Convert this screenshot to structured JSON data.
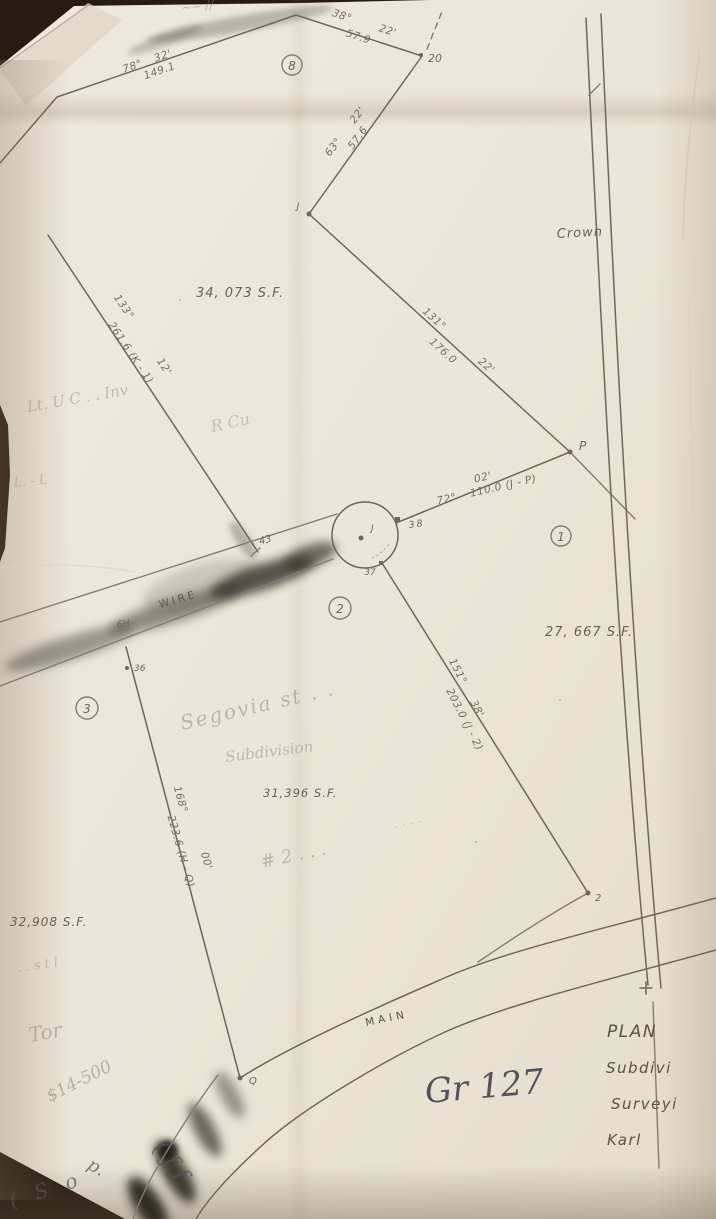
{
  "photo": {
    "description": "Photograph of a hand-drawn pencil subdivision survey plan on cream paper over a dark background",
    "paper_color": "#ece6d9",
    "background_color": "#281b10",
    "pencil_color": "#79715f",
    "pen_color": "#4c4c56"
  },
  "plan_reference": "Gr 127",
  "title_block": {
    "line1": "PLAN",
    "line2": "Subdivi",
    "line3": "Surveyi",
    "line4": "Karl"
  },
  "roads": {
    "main": "MAIN",
    "wire": "WIRE",
    "crown": "Crown"
  },
  "lots": {
    "lot8": {
      "number": "8",
      "area": "34, 073 S.F."
    },
    "lot1": {
      "number": "1",
      "area": "27, 667 S.F."
    },
    "lot2": {
      "number": "2",
      "area": "31,396 S.F."
    },
    "lot3": {
      "number": "3",
      "area": "32,908 S.F."
    }
  },
  "bearings": [
    {
      "deg": "78°",
      "min": "32'",
      "len": "149.1"
    },
    {
      "deg": "38°",
      "min": "22'",
      "len": "57.9"
    },
    {
      "deg": "63°",
      "min": "22'",
      "len": "57.6"
    },
    {
      "deg": "131°",
      "min": "22'",
      "len": "176.0"
    },
    {
      "deg": "133°",
      "min": "12'",
      "len": "261.6 (K - 1)"
    },
    {
      "deg": "72°",
      "min": "02'",
      "len": "110.0 (J - P)"
    },
    {
      "deg": "151°",
      "min": "38'",
      "len": "203.0 (J - 2)"
    },
    {
      "deg": "168°",
      "min": "00'",
      "len": "223.6 (H - Q)"
    }
  ],
  "points": {
    "p20": "20",
    "j_upper": "J",
    "p": "P",
    "n38": "38",
    "n37": "37",
    "n43": "43",
    "n36": "36",
    "n2": "2",
    "q": "Q",
    "j_center": "J",
    "h6": "6H"
  },
  "handwriting": {
    "top_edge": "~~ //",
    "note_left_upper": "Lt. U C . .  Inv",
    "note_r_cu": "R Cu",
    "note_l_l": "L. - L",
    "segovia": "Segovia  st . .",
    "subdivision": "Subdivision",
    "hash_note": "# 2 . . .",
    "dots": "· · · ·",
    "stl_note": ". .  s t  l",
    "tor": "Tor",
    "price": "$14-500",
    "pen_p": "p.",
    "pen_curl": "( ƒ ƒ",
    "pen_sol": "( S o"
  }
}
